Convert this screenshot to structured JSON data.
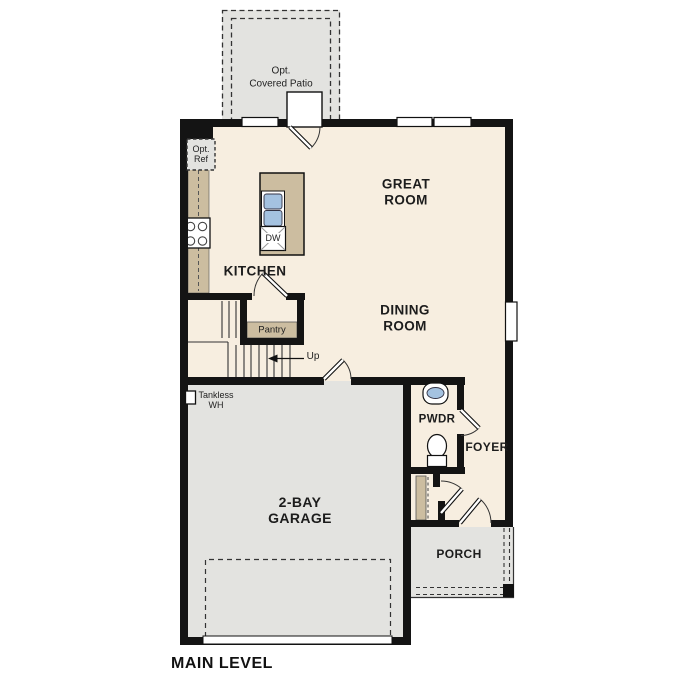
{
  "plan": {
    "title": "MAIN LEVEL",
    "rooms": {
      "great_room": "GREAT\nROOM",
      "dining_room": "DINING\nROOM",
      "kitchen": "KITCHEN",
      "garage": "2-BAY\nGARAGE",
      "powder": "PWDR",
      "foyer": "FOYER",
      "porch": "PORCH",
      "patio": "Opt.\nCovered Patio"
    },
    "labels": {
      "pantry": "Pantry",
      "opt_ref": "Opt.\nRef",
      "tankless": "Tankless\nWH",
      "up": "Up",
      "dishwasher": "DW"
    },
    "colors": {
      "floor": "#f7eee0",
      "exterior": "#e3e3e0",
      "cabinet": "#ccbda0",
      "fixture_blue": "#a4c2e0",
      "wall": "#141414"
    }
  }
}
